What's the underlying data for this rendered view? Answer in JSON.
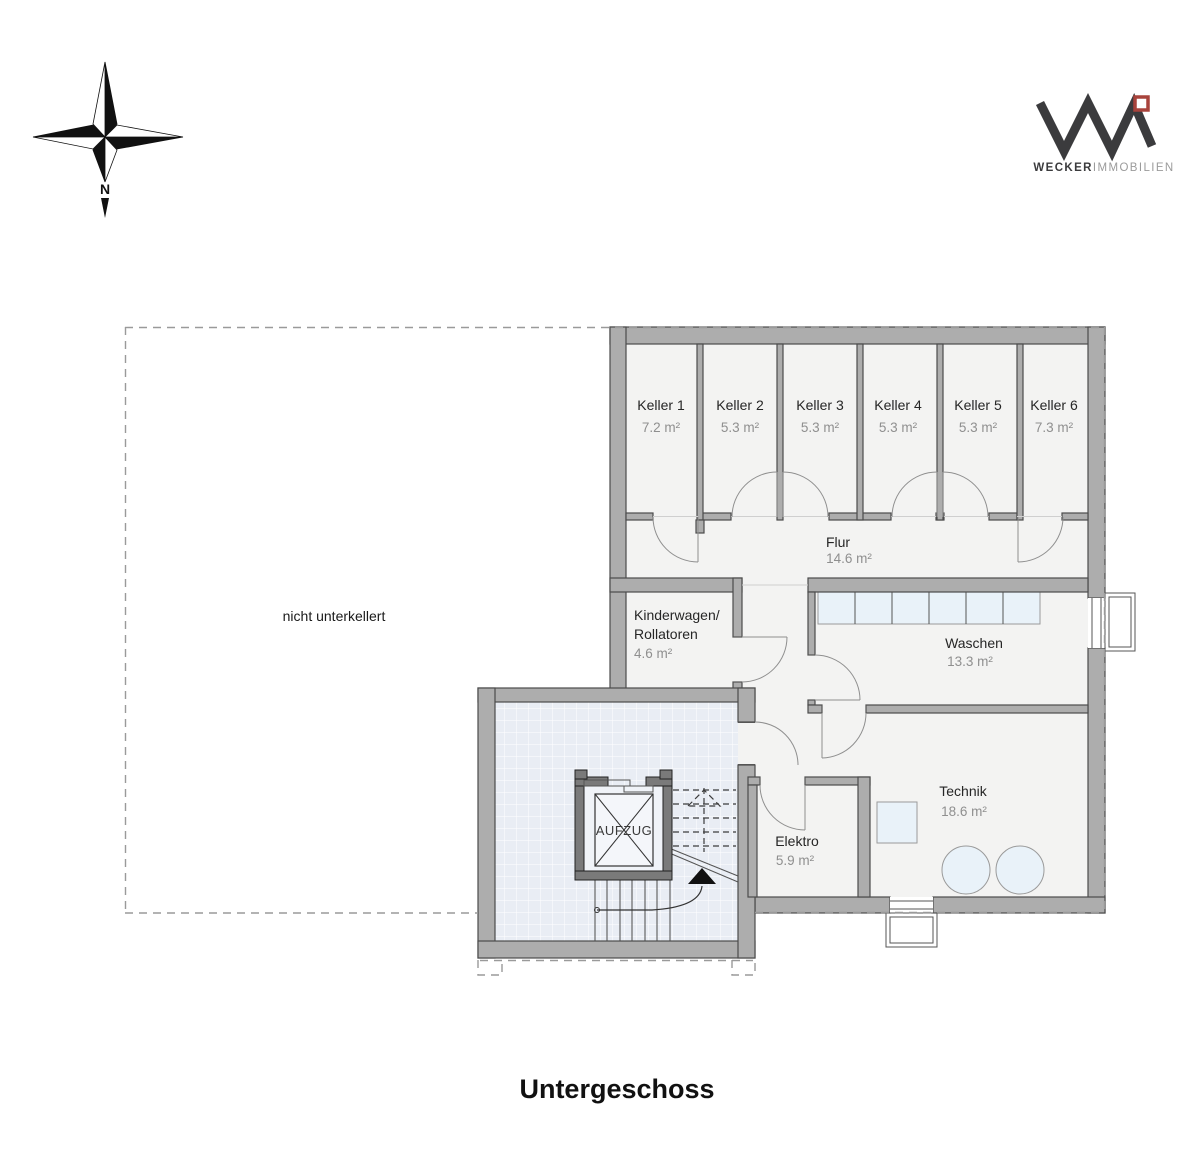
{
  "page": {
    "title": "Untergeschoss"
  },
  "compass": {
    "north_label": "N"
  },
  "logo": {
    "brand_bold": "WECKER",
    "brand_light": "IMMOBILIEN"
  },
  "plan": {
    "unexcavated_label": "nicht unterkellert",
    "elevator_label": "AUFZUG",
    "rooms": [
      {
        "name": "Keller 1",
        "area": "7.2 m²"
      },
      {
        "name": "Keller 2",
        "area": "5.3 m²"
      },
      {
        "name": "Keller 3",
        "area": "5.3 m²"
      },
      {
        "name": "Keller 4",
        "area": "5.3 m²"
      },
      {
        "name": "Keller 5",
        "area": "5.3 m²"
      },
      {
        "name": "Keller 6",
        "area": "7.3 m²"
      },
      {
        "name": "Flur",
        "area": "14.6 m²"
      },
      {
        "name": "Kinderwagen/",
        "name_line2": "Rollatoren",
        "area": "4.6 m²"
      },
      {
        "name": "Waschen",
        "area": "13.3 m²"
      },
      {
        "name": "Technik",
        "area": "18.6 m²"
      },
      {
        "name": "Elektro",
        "area": "5.9 m²"
      }
    ]
  },
  "colors": {
    "wall": "#adadad",
    "floor": "#f3f3f2",
    "tile": "#e9edf4",
    "fixture": "#e9f2f9",
    "logo_accent": "#a8433c"
  }
}
